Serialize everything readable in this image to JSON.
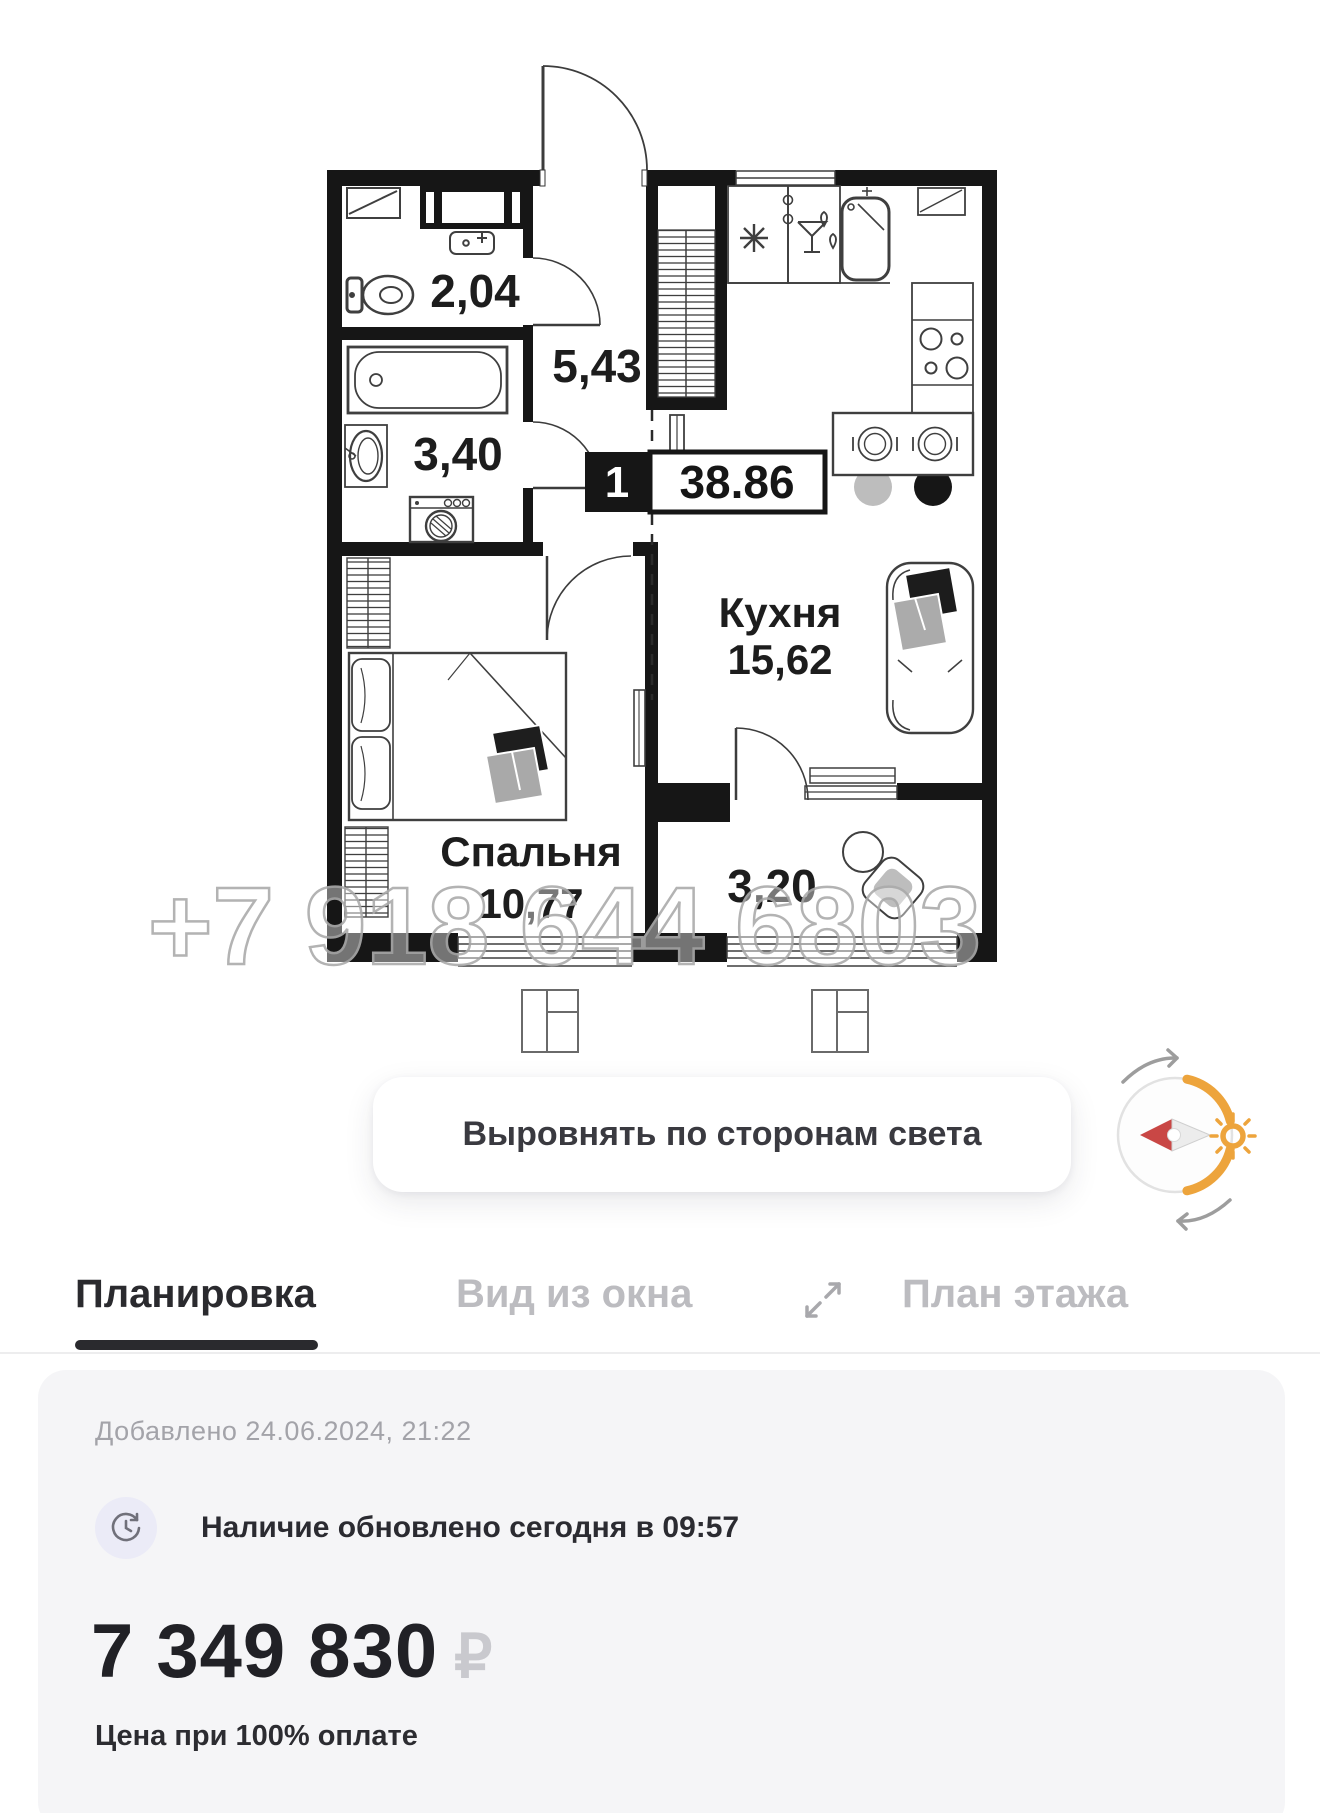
{
  "floor_plan": {
    "badge": {
      "room_count": "1",
      "total_area": "38.86"
    },
    "rooms": {
      "wc": {
        "area": "2,04"
      },
      "hall": {
        "area": "5,43"
      },
      "bathroom": {
        "area": "3,40"
      },
      "kitchen": {
        "name": "Кухня",
        "area": "15,62"
      },
      "bedroom": {
        "name": "Спальня",
        "area": "10,77"
      },
      "entry": {
        "area": "3,20"
      }
    },
    "watermark": "+7 918 644 6803"
  },
  "controls": {
    "align_button": "Выровнять по сторонам света"
  },
  "tabs": [
    {
      "label": "Планировка",
      "active": true
    },
    {
      "label": "Вид из окна",
      "active": false
    },
    {
      "label": "План этажа",
      "active": false
    }
  ],
  "details": {
    "added": "Добавлено 24.06.2024, 21:22",
    "availability": "Наличие обновлено сегодня в 09:57",
    "price": "7 349 830",
    "currency": "₽",
    "price_note": "Цена при 100% оплате"
  },
  "colors": {
    "wall": "#161616",
    "accent_orange": "#eda43c",
    "needle_red": "#c94745",
    "tab_active": "#2a2a2e",
    "tab_inactive": "#bcbcc0",
    "card_bg": "#f5f5f7",
    "watermark_gray": "#ababab"
  }
}
